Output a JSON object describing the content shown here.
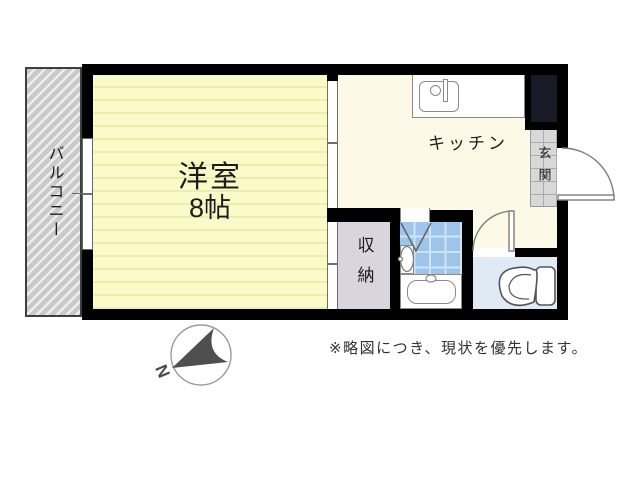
{
  "plan": {
    "rooms": {
      "western_room": {
        "name": "洋室",
        "size": "8帖"
      },
      "kitchen": {
        "name": "キッチン"
      },
      "closet": {
        "name": "収納"
      },
      "entrance": {
        "name": "玄関"
      },
      "balcony": {
        "name": "バルコニー"
      }
    },
    "compass": {
      "north_label": "N"
    },
    "note": "※略図につき、現状を優先します。"
  },
  "colors": {
    "wall": "#000000",
    "western_room_fill": "#fbfbc9",
    "western_room_stripe": "#ededae",
    "kitchen_fill": "#fcfae7",
    "closet_fill": "#d9d4dd",
    "bath_tile": "#9fc4e9",
    "toilet_fill": "#e0eaf5",
    "entrance_tile": "#d8d8d8",
    "balcony_fill": "#c9c9c9",
    "shaft_fill": "#191928"
  }
}
